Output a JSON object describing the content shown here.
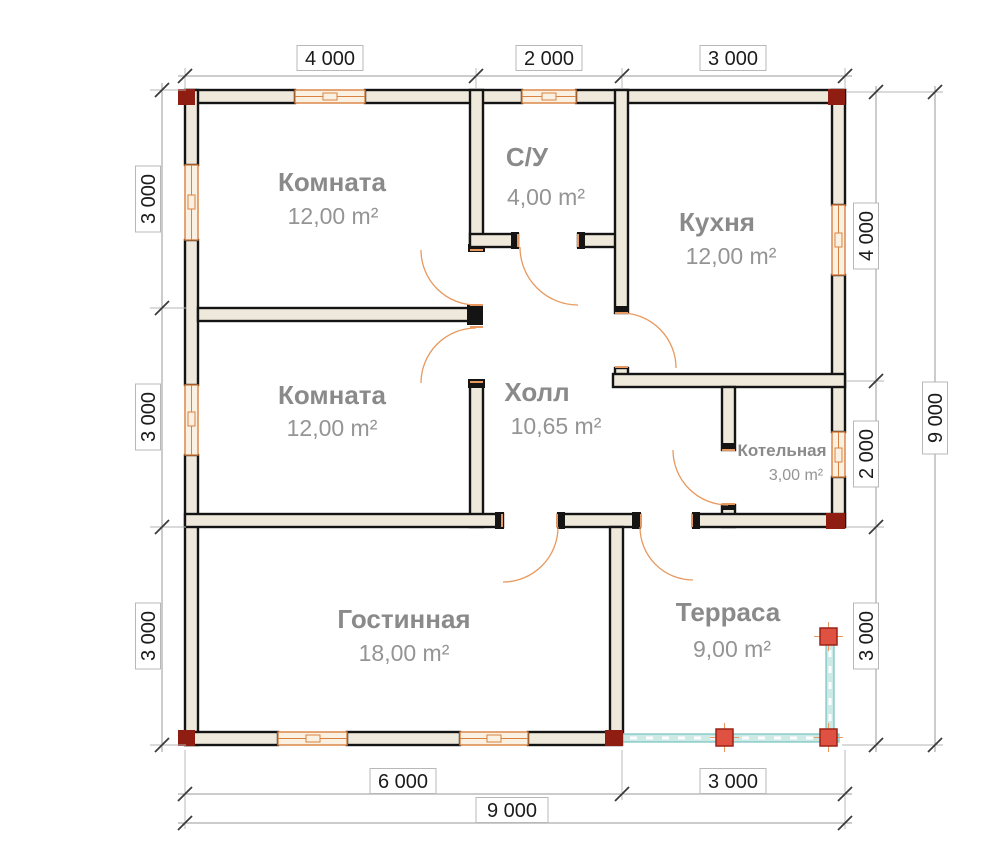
{
  "plan": {
    "rooms": {
      "room1": {
        "name": "Комната",
        "area": "12,00 m²"
      },
      "bathroom": {
        "name": "С/У",
        "area": "4,00 m²"
      },
      "kitchen": {
        "name": "Кухня",
        "area": "12,00 m²"
      },
      "room2": {
        "name": "Комната",
        "area": "12,00 m²"
      },
      "hall": {
        "name": "Холл",
        "area": "10,65 m²"
      },
      "boiler": {
        "name": "Котельная",
        "area": "3,00 m²"
      },
      "living": {
        "name": "Гостинная",
        "area": "18,00 m²"
      },
      "terrace": {
        "name": "Терраса",
        "area": "9,00 m²"
      }
    },
    "dims": {
      "top": [
        "4 000",
        "2 000",
        "3 000"
      ],
      "left": [
        "3 000",
        "3 000",
        "3 000"
      ],
      "right": [
        "4 000",
        "2 000",
        "3 000"
      ],
      "right_total": "9 000",
      "bottom": [
        "6 000",
        "3 000"
      ],
      "bottom_total": "9 000"
    },
    "colors": {
      "wall_fill": "#efe9dc",
      "wall_stroke": "#141414",
      "window": "#d9813f",
      "window_fill": "#fbf1e2",
      "door_arc": "#e8995f",
      "railing": "#5fb8b4",
      "railing_fill": "#cdeae7",
      "post_red": "#df5140",
      "corner_red": "#8f1d12",
      "label_gray": "#8a8a8a",
      "dim_text": "#1b1b1b",
      "dim_line": "#9a9a9a"
    }
  }
}
